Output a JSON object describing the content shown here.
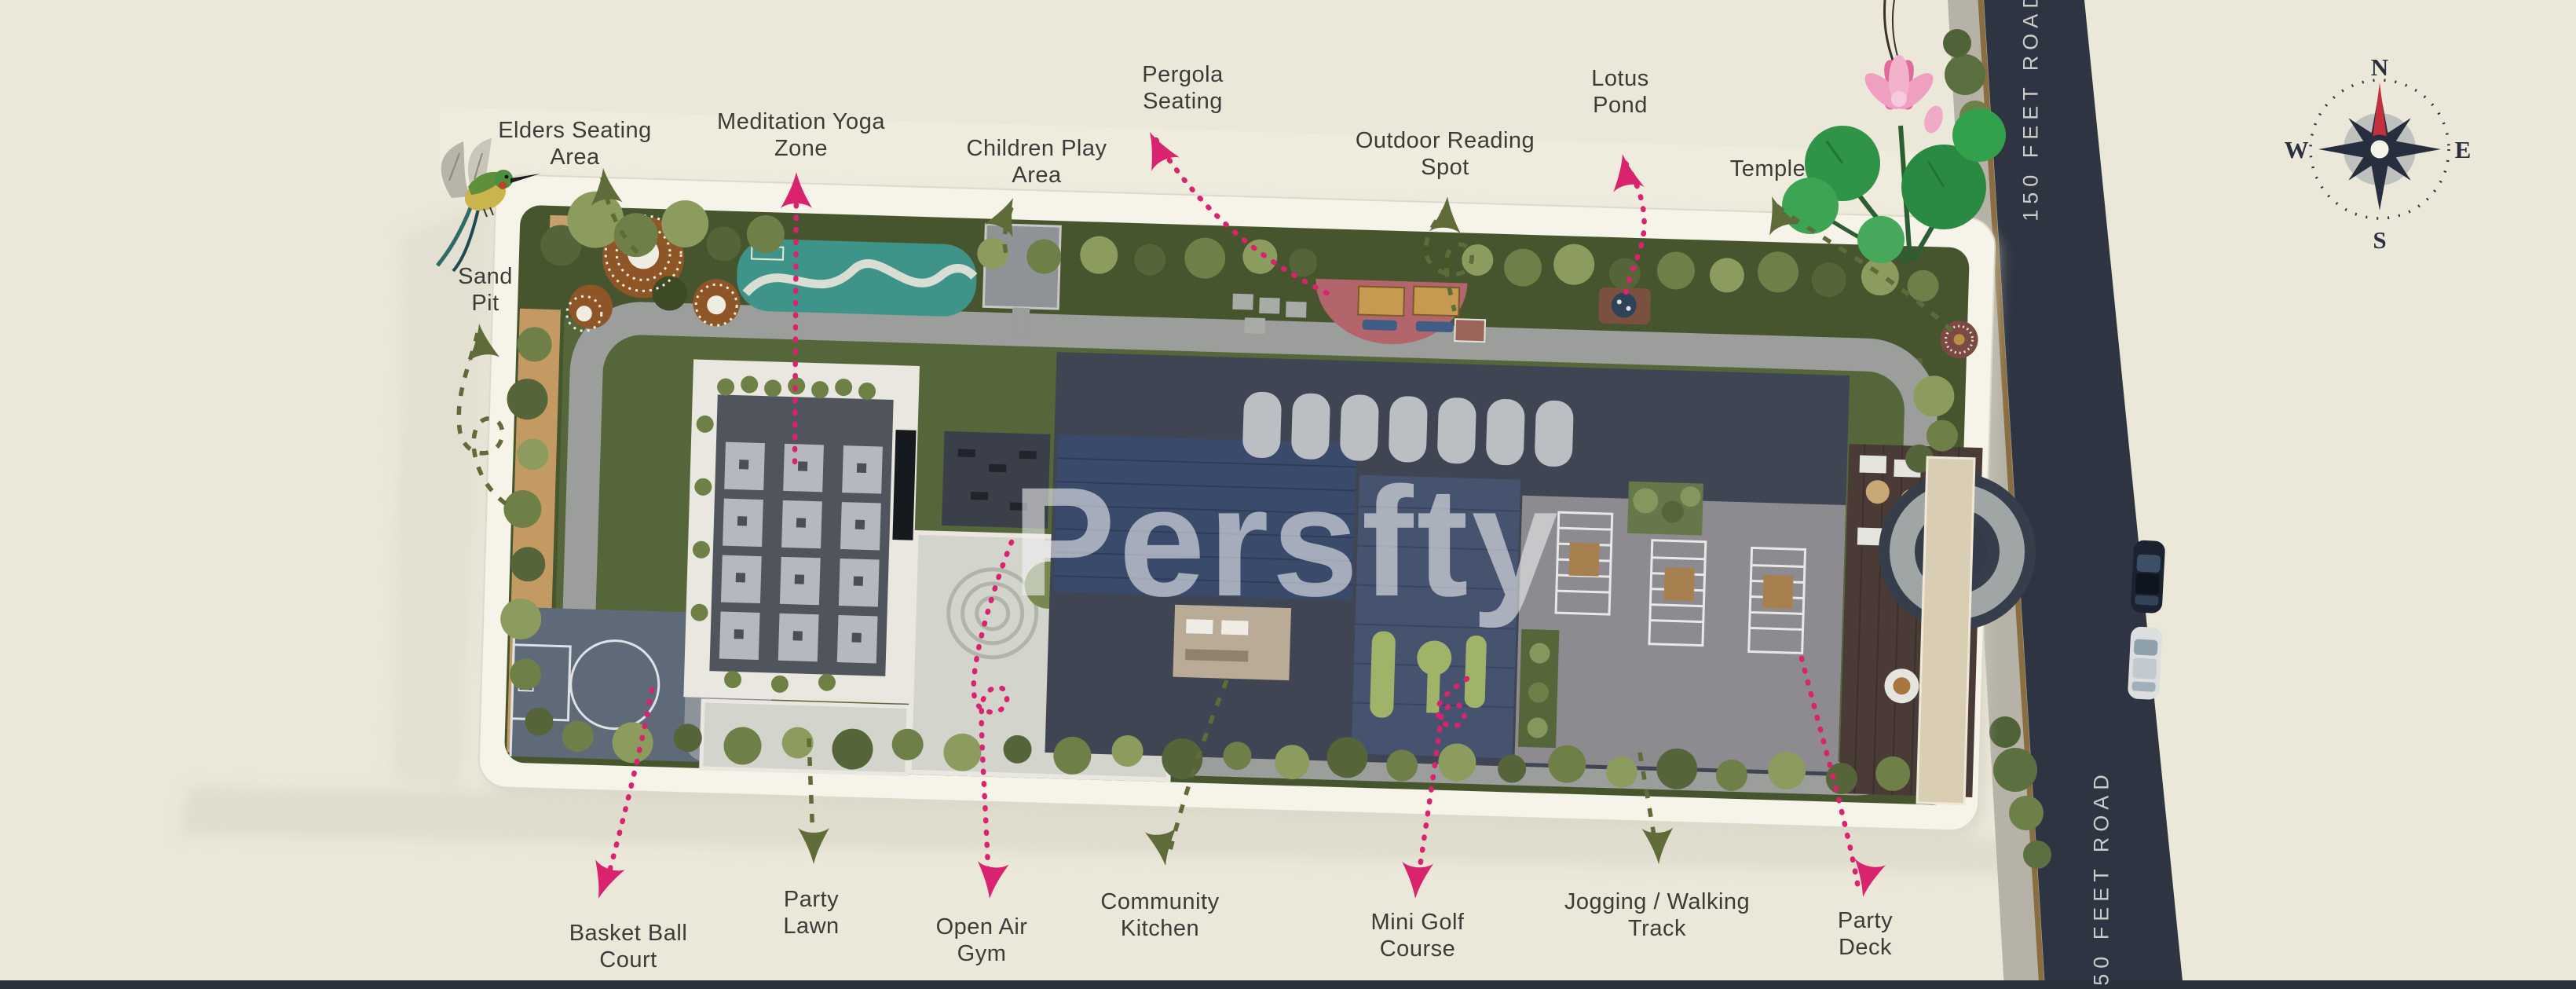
{
  "watermark": {
    "text": "Persfty"
  },
  "road": {
    "name": "150 FEET ROAD"
  },
  "compass": {
    "n": "N",
    "e": "E",
    "s": "S",
    "w": "W"
  },
  "labels": {
    "elders": {
      "line1": "Elders Seating",
      "line2": "Area"
    },
    "meditation": {
      "line1": "Meditation Yoga",
      "line2": "Zone"
    },
    "children": {
      "line1": "Children Play",
      "line2": "Area"
    },
    "pergola": {
      "line1": "Pergola",
      "line2": "Seating"
    },
    "reading": {
      "line1": "Outdoor Reading",
      "line2": "Spot"
    },
    "lotus": {
      "line1": "Lotus",
      "line2": "Pond"
    },
    "temple": {
      "line1": "Temple"
    },
    "sandpit": {
      "line1": "Sand",
      "line2": "Pit"
    },
    "basketball": {
      "line1": "Basket Ball",
      "line2": "Court"
    },
    "partylawn": {
      "line1": "Party",
      "line2": "Lawn"
    },
    "gym": {
      "line1": "Open Air",
      "line2": "Gym"
    },
    "kitchen": {
      "line1": "Community",
      "line2": "Kitchen"
    },
    "minigolf": {
      "line1": "Mini Golf",
      "line2": "Course"
    },
    "jogging": {
      "line1": "Jogging / Walking",
      "line2": "Track"
    },
    "partydeck": {
      "line1": "Party",
      "line2": "Deck"
    }
  },
  "colors": {
    "pink": "#d9236f",
    "olive": "#5f6b39",
    "label_ink": "#3b3b38",
    "road_navy": "#2e3441",
    "background_cream": "#ebe8da",
    "yoga_teal": "#3f948a",
    "watermark_white": "#f2f3f5"
  }
}
